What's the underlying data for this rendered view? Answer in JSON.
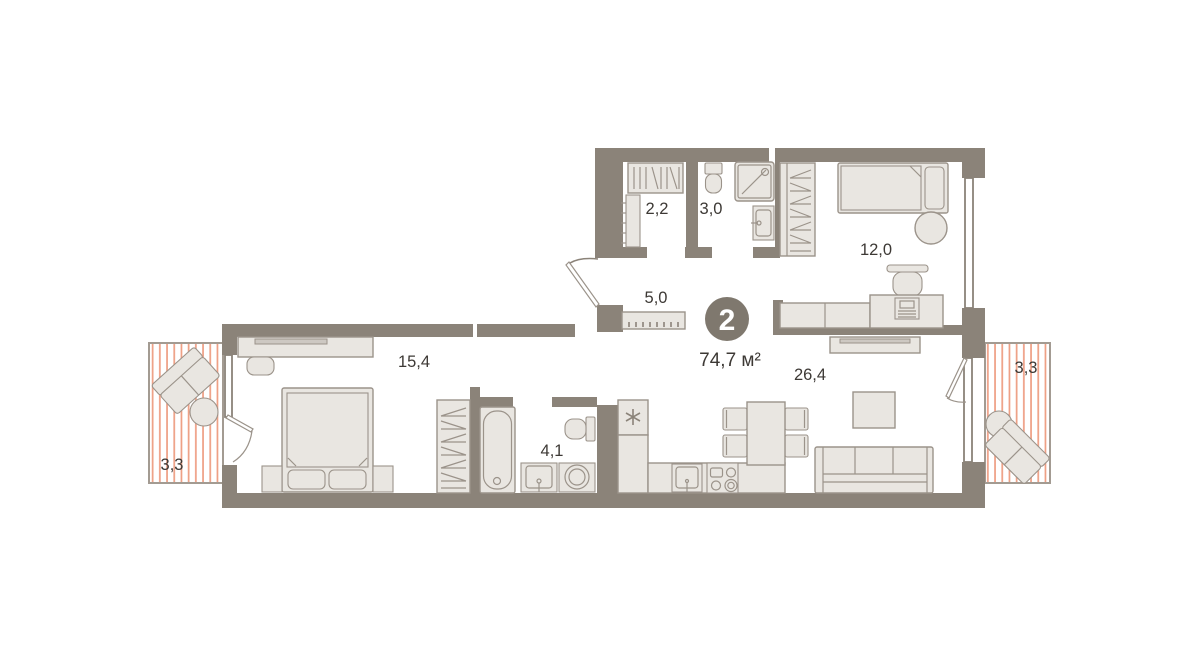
{
  "plan": {
    "title": "apartment-floor-plan",
    "badge": {
      "room_count": "2",
      "area": "74,7 м²"
    },
    "rooms": [
      {
        "name": "dressing-room",
        "area_label": "2,2"
      },
      {
        "name": "bathroom-guest",
        "area_label": "3,0"
      },
      {
        "name": "bedroom",
        "area_label": "12,0"
      },
      {
        "name": "hallway",
        "area_label": "5,0"
      },
      {
        "name": "bedroom-master",
        "area_label": "15,4"
      },
      {
        "name": "bathroom",
        "area_label": "4,1"
      },
      {
        "name": "kitchen-living-room",
        "area_label": "26,4"
      },
      {
        "name": "balcony-left",
        "area_label": "3,3"
      },
      {
        "name": "balcony-right",
        "area_label": "3,3"
      }
    ],
    "colors": {
      "wall": "#8b8379",
      "furniture_fill": "#e9e6e1",
      "furniture_stroke": "#9b938a",
      "balcony_stripe": "#ee9e83",
      "text": "#3d3935",
      "badge_background": "#7f786e",
      "badge_text": "#ffffff"
    },
    "furniture_icons": [
      "hanger-rack-icon",
      "shelf-column-icon",
      "toilet-icon",
      "shower-cabin-icon",
      "washbasin-icon",
      "single-bed-icon",
      "pouf-icon",
      "office-chair-icon",
      "desk-icon",
      "computer-icon",
      "tv-stand-icon",
      "coat-closet-icon",
      "entrance-door-icon",
      "shoe-bench-icon",
      "dresser-tv-icon",
      "stool-icon",
      "double-bed-icon",
      "nightstand-icon",
      "wardrobe-icon",
      "bathtub-icon",
      "washing-machine-icon",
      "fridge-icon",
      "kitchen-counter-icon",
      "kitchen-sink-icon",
      "stove-icon",
      "dining-table-icon",
      "chair-icon",
      "coffee-table-icon",
      "sofa-icon",
      "armchair-icon",
      "balcony-table-icon"
    ]
  }
}
